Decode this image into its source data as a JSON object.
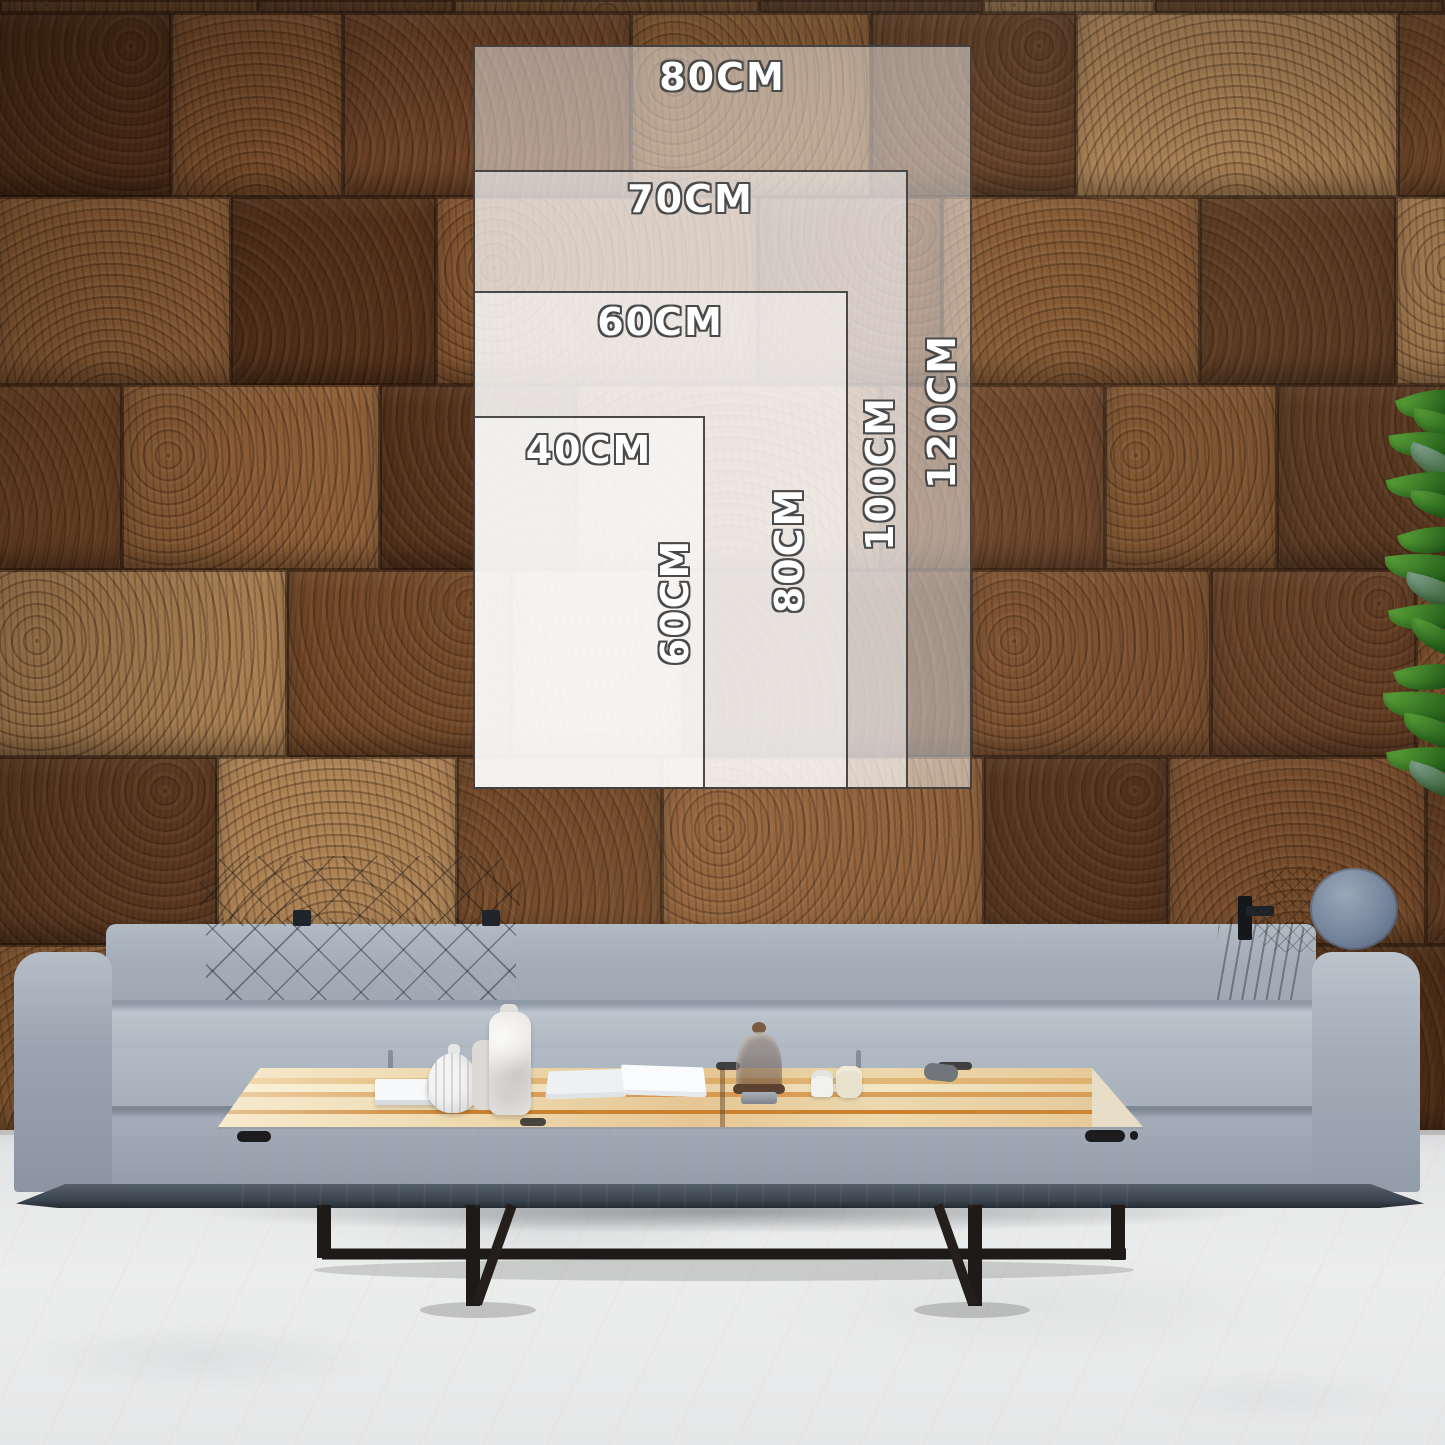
{
  "size_guide": {
    "border_color": "#3c3c3c",
    "label_fill": "#ffffff",
    "label_outline": "#4a4a4a",
    "overlay_tint": "rgba(255,255,255,0.47)",
    "sizes": [
      {
        "name": "80x120cm",
        "width_label": "80CM",
        "height_label": "120CM"
      },
      {
        "name": "70x100cm",
        "width_label": "70CM",
        "height_label": "100CM"
      },
      {
        "name": "60x80cm",
        "width_label": "60CM",
        "height_label": "80CM"
      },
      {
        "name": "40x60cm",
        "width_label": "40CM",
        "height_label": "60CM"
      }
    ]
  },
  "scene": {
    "wall": {
      "palette": [
        "#7f512e",
        "#5d3a21",
        "#8f6038",
        "#6b4226",
        "#ab8153",
        "#523019",
        "#845730",
        "#704626"
      ],
      "seam_color": "#2b1608"
    },
    "floor": {
      "base": "#eceded",
      "vein": "#d6d8da",
      "speck": "#cdb88a"
    },
    "sofa": {
      "fabric": "#a7b0bb",
      "fabric_dark": "#8d97a3",
      "headrest": "#3e4653",
      "pillow": "#3f3a36",
      "bolster_brown": "#46311f",
      "bolster_cap": "#8392a6",
      "base_plinth": "#49545f"
    },
    "table": {
      "top_light": "#ecd8ad",
      "streak": "#c9822f",
      "front": "#f3ecdc",
      "metal": "#1d1a18"
    },
    "plant": {
      "greens": [
        "#2e6b1f",
        "#5ca33b",
        "#1f4a16",
        "#86a794"
      ]
    }
  }
}
